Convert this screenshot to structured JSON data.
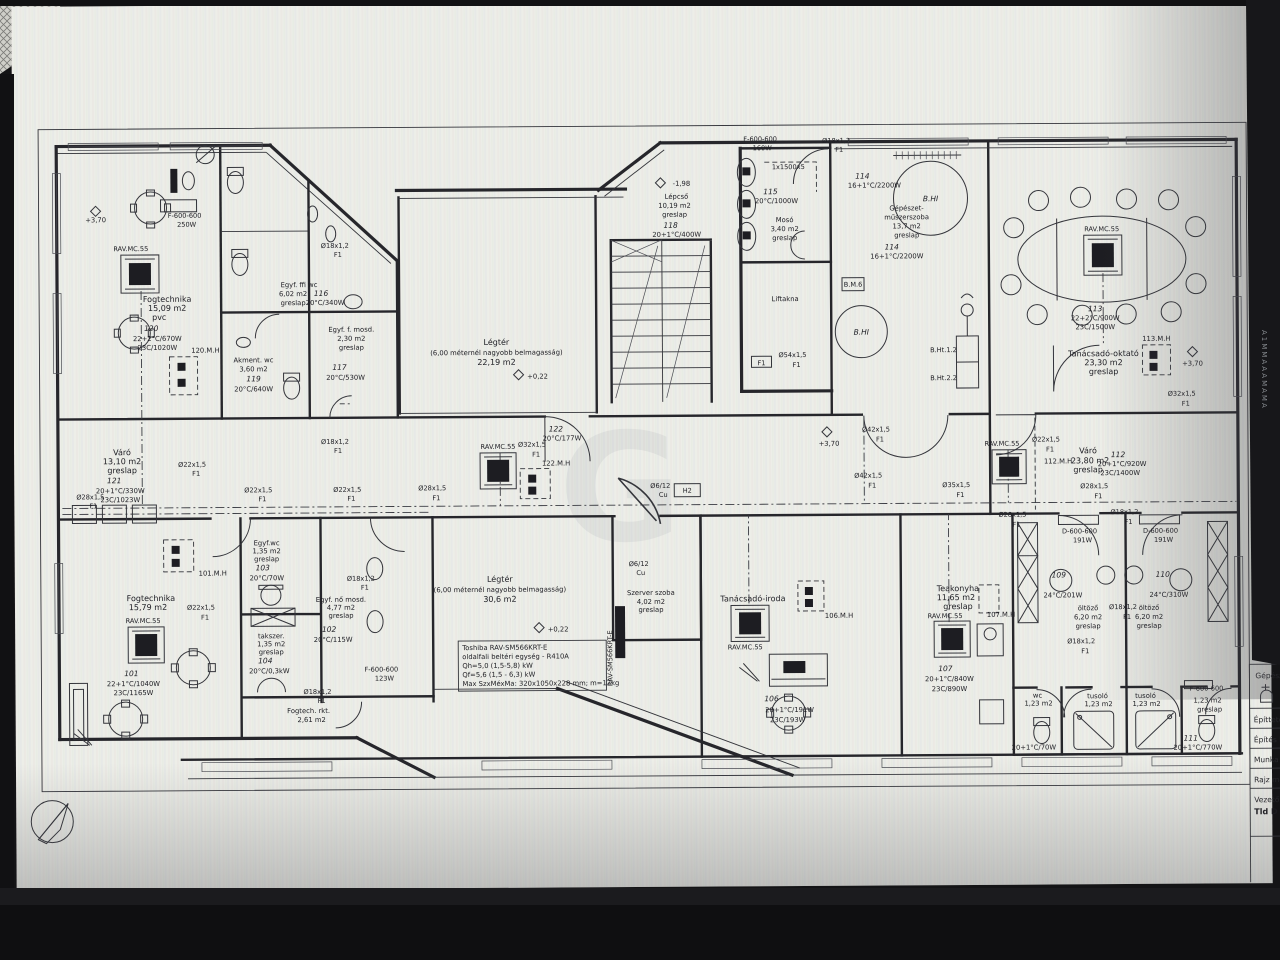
{
  "photo": {
    "background": "#141416",
    "sheet": "#edeee8",
    "ink": "#26262b"
  },
  "watermark": "G",
  "edge_note": "A1MMAAAMAMA",
  "ac_label": "RAV.MC.55",
  "levels": {
    "p370": "+3,70",
    "p022": "+0,22",
    "m198": "-1,98"
  },
  "pipes": {
    "d18": "Ø18x1,2",
    "d22": "Ø22x1,5",
    "d28": "Ø28x1,5",
    "d32": "Ø32x1,5",
    "d35": "Ø35x1,5",
    "d42": "Ø42x1,5",
    "d54": "Ø54x1,5",
    "f1": "F1",
    "h2": "H2",
    "cu612": "Ø6/12",
    "cu": "Cu"
  },
  "rad": {
    "f600": "F-600-600",
    "d600": "D-600-600",
    "w160": "160W",
    "w250": "250W",
    "w191": "191W",
    "w123": "123W",
    "note1500": "1x1500x5"
  },
  "tags": {
    "mh120": "120.M.H",
    "mh101": "101.M.H",
    "mh122": "122.M.H",
    "mh113": "113.M.H",
    "mh112": "112.M.H",
    "mh106": "106.M.H",
    "mh107": "107.M.H",
    "bhi": "B.HI",
    "bm6": "B.M.6",
    "bht12": "B.Ht.1.2",
    "bht22": "B.Ht.2.2"
  },
  "rooms": {
    "r120": {
      "name": "Fogtechnika",
      "area": "15,09 m2",
      "floor": "pvc",
      "num": "120",
      "h1": "22+2°C/670W",
      "h2": "23C/1020W"
    },
    "r116": {
      "name": "Egyf. ffi wc",
      "area": "6,02 m2",
      "floor": "greslap",
      "num": "116",
      "h1": "20°C/340W"
    },
    "r117": {
      "name": "Egyf. f. mosd.",
      "area": "2,30 m2",
      "floor": "greslap",
      "num": "117",
      "h1": "20°C/530W"
    },
    "r119": {
      "name": "Akment. wc",
      "area": "3,60 m2",
      "num": "119",
      "h1": "20°C/640W"
    },
    "r121": {
      "name": "Váró",
      "area": "13,10 m2",
      "floor": "greslap",
      "num": "121",
      "h1": "20+1°C/330W",
      "h2": "23C/1023W"
    },
    "r101": {
      "name": "Fogtechnika",
      "area": "15,79 m2",
      "num": "101",
      "h1": "22+1°C/1040W",
      "h2": "23C/1165W"
    },
    "r103": {
      "name": "Egyf.wc",
      "area": "1,35 m2",
      "floor": "greslap",
      "num": "103",
      "h1": "20°C/70W"
    },
    "r104": {
      "name": "takszer.",
      "area": "1,35 m2",
      "floor": "greslap",
      "num": "104",
      "h1": "20°C/0,3kW"
    },
    "r102": {
      "name": "Egyf. nő mosd.",
      "area": "4,77 m2",
      "floor": "greslap",
      "num": "102",
      "h1": "20°C/115W"
    },
    "rkt": {
      "name": "Fogtech. rkt.",
      "area": "2,61 m2"
    },
    "legter1": {
      "name": "Légtér",
      "sub": "(6,00 méternél nagyobb belmagasság)",
      "area": "22,19 m2"
    },
    "legter2": {
      "name": "Légtér",
      "sub": "(6,00 méternél nagyobb belmagasság)",
      "area": "30,6 m2"
    },
    "r118": {
      "name": "Lépcső",
      "area": "10,19 m2",
      "floor": "greslap",
      "num": "118",
      "h1": "20+1°C/400W"
    },
    "r115": {
      "name": "Mosó",
      "area": "3,40 m2",
      "floor": "greslap",
      "num": "115",
      "h1": "20°C/1000W"
    },
    "lift": {
      "name": "Liftakna"
    },
    "r114": {
      "name1": "Gépészet-",
      "name2": "műszerszoba",
      "area": "13,7 m2",
      "floor": "greslap",
      "num": "114",
      "h1": "16+1°C/2200W"
    },
    "r113": {
      "name": "Tanácsadó-oktató",
      "area": "23,30 m2",
      "floor": "greslap",
      "num": "113",
      "h1": "22+2°C/900W",
      "h2": "23C/1500W"
    },
    "r112": {
      "name": "Váró",
      "area": "23,80 m2",
      "floor": "greslap",
      "num": "112",
      "h1": "20+1°C/920W",
      "h2": "23C/1400W"
    },
    "szerver": {
      "name": "Szerver szoba",
      "area": "4,02 m2",
      "floor": "greslap"
    },
    "r106": {
      "name": "Tanácsadó-iroda",
      "num": "106",
      "h1": "20+1°C/191W",
      "h2": "23C/193W"
    },
    "r107": {
      "name": "Teakonyha",
      "area": "11,65 m2",
      "floor": "greslap",
      "num": "107",
      "h1": "20+1°C/840W",
      "h2": "23C/890W"
    },
    "r109": {
      "name": "öltöző",
      "area": "6,20 m2",
      "floor": "greslap",
      "num": "109",
      "h1": "24°C/201W"
    },
    "r110": {
      "name": "öltöző",
      "area": "6,20 m2",
      "floor": "greslap",
      "num": "110",
      "h1": "24°C/310W"
    },
    "wcl": {
      "name": "wc",
      "area": "1,23 m2",
      "h1": "20+1°C/70W"
    },
    "tus": {
      "name": "tusoló",
      "area": "1,23 m2"
    },
    "r111": {
      "name": "wc",
      "area": "1,23 m2",
      "floor": "greslap",
      "num": "111",
      "h1": "20+1°C/770W"
    },
    "r122": {
      "num": "122",
      "h1": "20°C/177W"
    }
  },
  "unitbox": {
    "l1": "Toshiba RAV-SM566KRT-E",
    "l2": "oldalfali beltéri egység - R410A",
    "l3": "Qh=5,0 (1,5-5,8) kW",
    "l4": "Qf=5,6 (1,5 - 6,3) kW",
    "l5": "Max SzxMéxMa: 320x1050x228 mm; m=12kg",
    "vert": "RAV-SM566KRT-E"
  },
  "titleblock": {
    "r1": "Gépész",
    "r2": "Építtető",
    "r3": "Építés h",
    "r4": "Munka m",
    "r5": "Rajz me",
    "r6": "Vezető te",
    "r7": "Tld D"
  }
}
